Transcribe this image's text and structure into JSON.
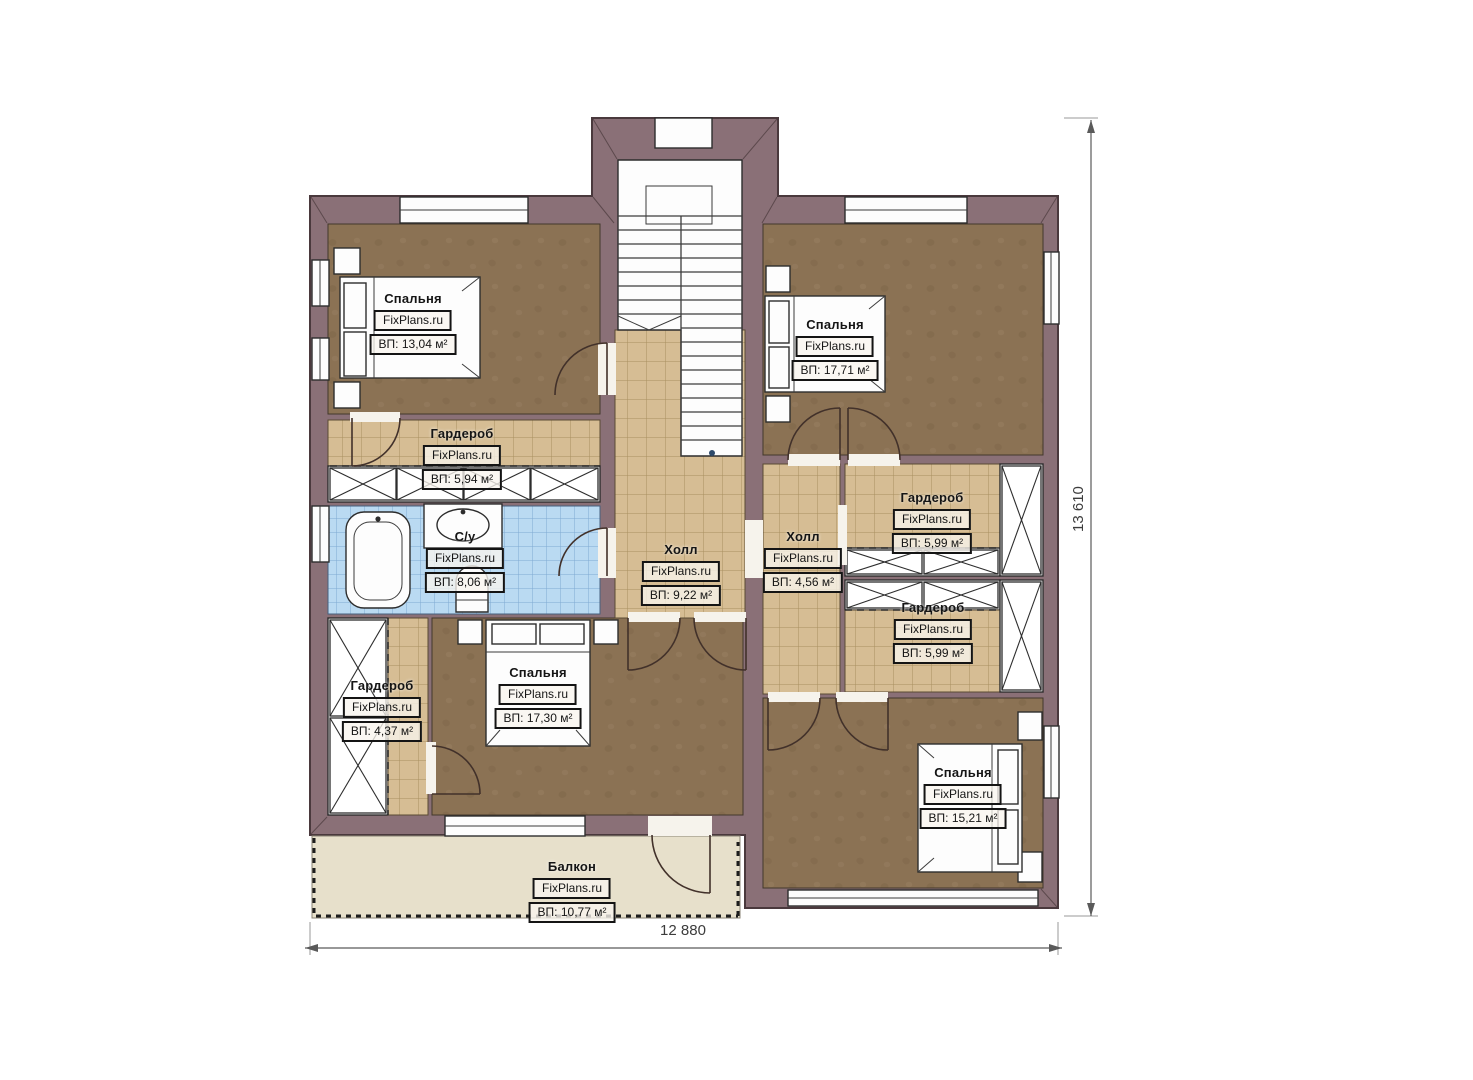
{
  "plan": {
    "dimensions": {
      "width": "12 880",
      "height": "13 610"
    },
    "colors": {
      "wall": "#8a7077",
      "floor": "#8b7254",
      "tile": "#d6bd94",
      "tile_line": "#a8905f",
      "bath": "#badaf2",
      "bath_line": "#7fa9d2",
      "balcony": "#e7e0cb"
    },
    "rooms": [
      {
        "id": "bedroom-top-left",
        "name": "Спальня",
        "watermark": "FixPlans.ru",
        "area": "ВП: 13,04 м²"
      },
      {
        "id": "wardrobe-left",
        "name": "Гардероб",
        "watermark": "FixPlans.ru",
        "area": "ВП: 5,94 м²"
      },
      {
        "id": "bathroom",
        "name": "С/у",
        "watermark": "FixPlans.ru",
        "area": "ВП: 8,06 м²"
      },
      {
        "id": "hall-center",
        "name": "Холл",
        "watermark": "FixPlans.ru",
        "area": "ВП: 9,22 м²"
      },
      {
        "id": "bedroom-top-right",
        "name": "Спальня",
        "watermark": "FixPlans.ru",
        "area": "ВП: 17,71 м²"
      },
      {
        "id": "hall-right",
        "name": "Холл",
        "watermark": "FixPlans.ru",
        "area": "ВП: 4,56 м²"
      },
      {
        "id": "wardrobe-right-top",
        "name": "Гардероб",
        "watermark": "FixPlans.ru",
        "area": "ВП: 5,99 м²"
      },
      {
        "id": "wardrobe-right-bottom",
        "name": "Гардероб",
        "watermark": "FixPlans.ru",
        "area": "ВП: 5,99 м²"
      },
      {
        "id": "wardrobe-left-bottom",
        "name": "Гардероб",
        "watermark": "FixPlans.ru",
        "area": "ВП: 4,37 м²"
      },
      {
        "id": "bedroom-bottom-center",
        "name": "Спальня",
        "watermark": "FixPlans.ru",
        "area": "ВП: 17,30 м²"
      },
      {
        "id": "bedroom-bottom-right",
        "name": "Спальня",
        "watermark": "FixPlans.ru",
        "area": "ВП: 15,21 м²"
      },
      {
        "id": "balcony",
        "name": "Балкон",
        "watermark": "FixPlans.ru",
        "area": "ВП: 10,77 м²"
      }
    ]
  }
}
